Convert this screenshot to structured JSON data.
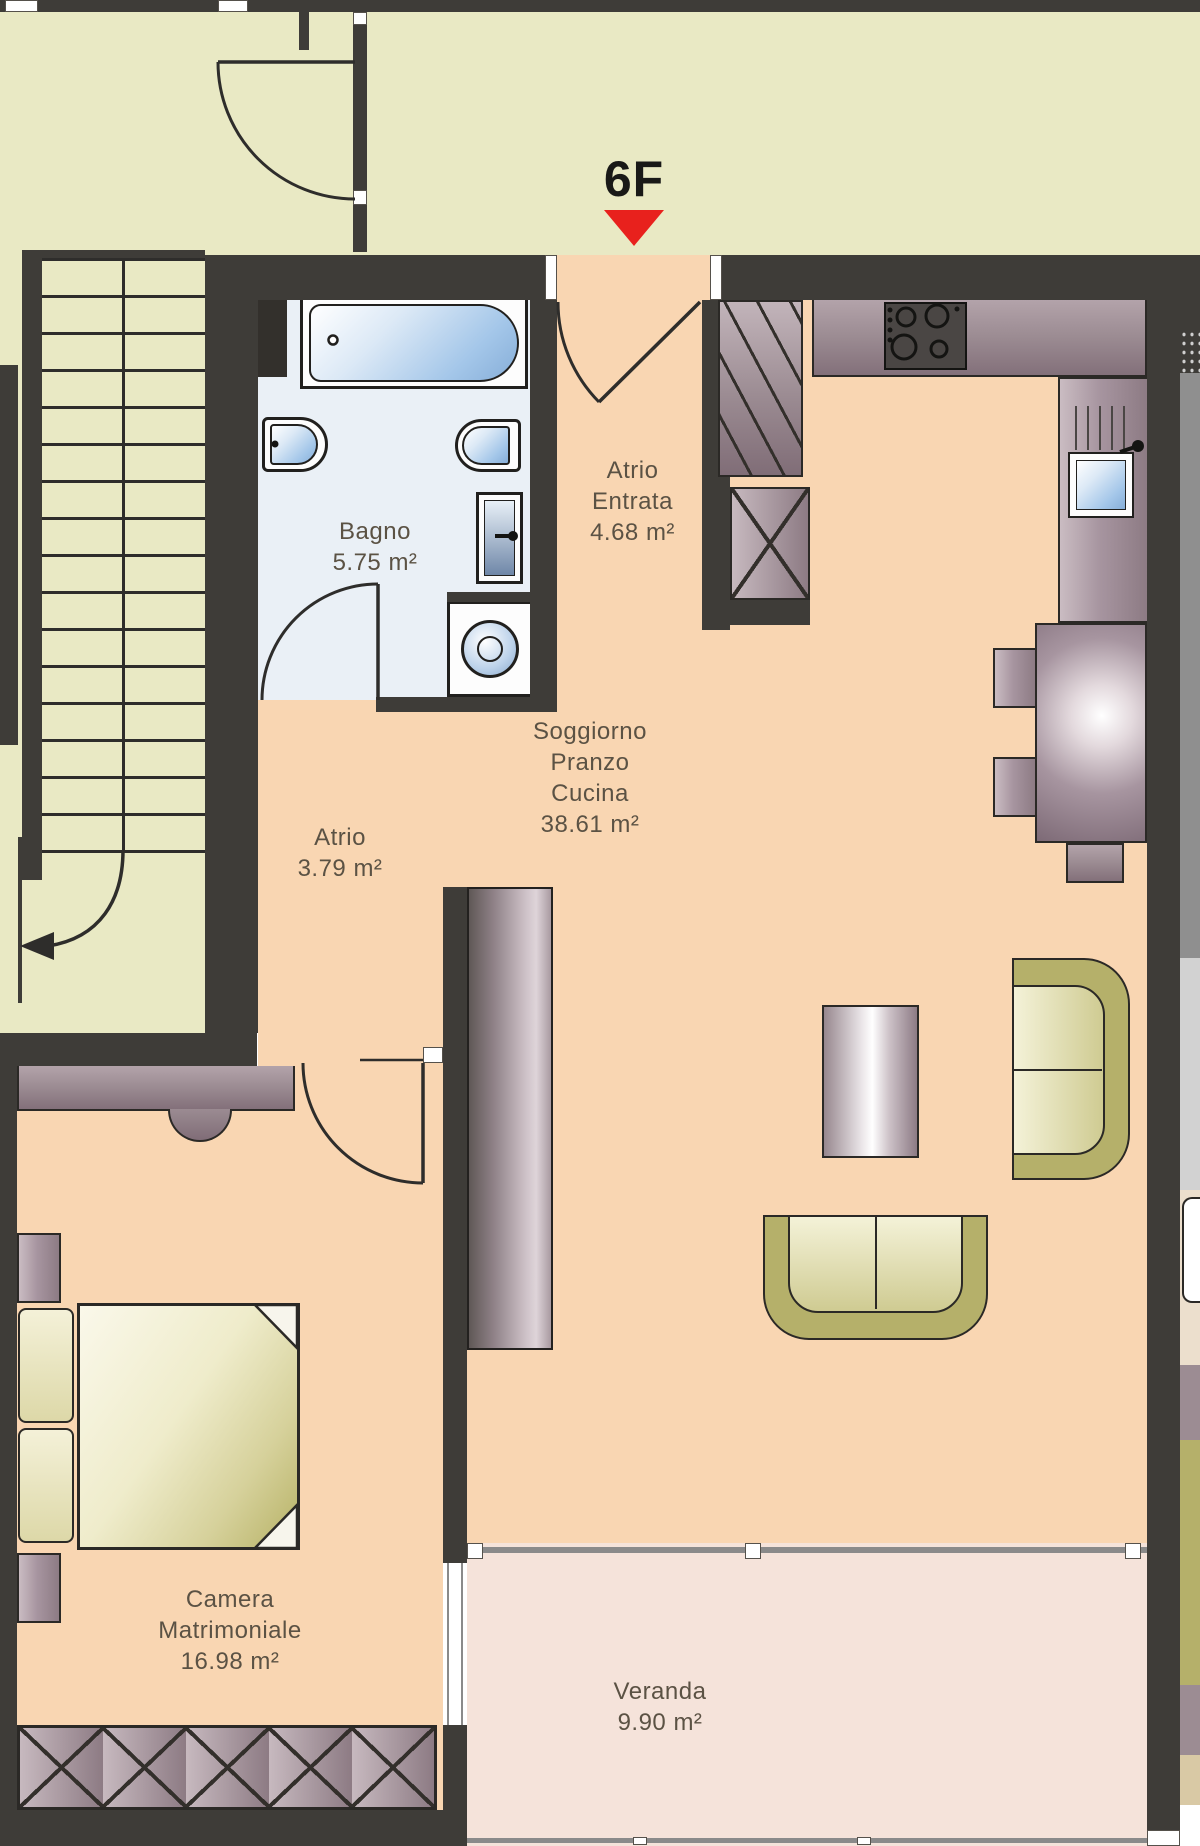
{
  "unit": {
    "label": "6F"
  },
  "rooms": {
    "bagno": {
      "name": "Bagno",
      "area": "5.75 m²"
    },
    "atrio_entrata": {
      "name": "Atrio",
      "name2": "Entrata",
      "area": "4.68 m²"
    },
    "atrio": {
      "name": "Atrio",
      "area": "3.79 m²"
    },
    "soggiorno": {
      "name": "Soggiorno",
      "name2": "Pranzo",
      "name3": "Cucina",
      "area": "38.61 m²"
    },
    "camera": {
      "name": "Camera",
      "name2": "Matrimoniale",
      "area": "16.98 m²"
    },
    "veranda": {
      "name": "Veranda",
      "area": "9.90 m²"
    }
  },
  "colors": {
    "wall": "#3e3c38",
    "floor-main": "#f9d6b2",
    "floor-veranda": "#f5e3da",
    "floor-stair": "#e9e9c4",
    "floor-bath": "#eaf0f6",
    "accent-marker": "#e8211d",
    "furniture-mauve": "#96868d",
    "furniture-olive": "#b5b06a",
    "fixture-blue": "#a3c6e9",
    "label-text": "#5b5244"
  }
}
